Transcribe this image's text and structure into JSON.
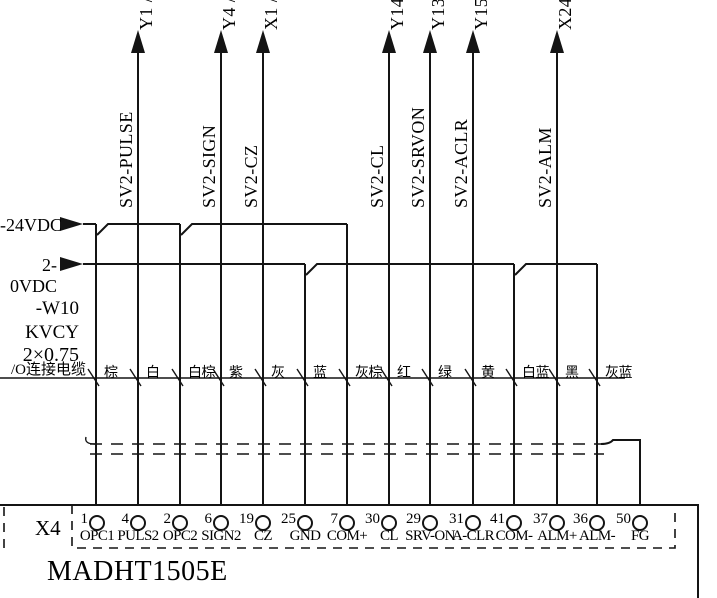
{
  "title_block": {
    "device_model": "MADHT1505E",
    "connector": "X4"
  },
  "rails": [
    {
      "label": "-24VDC",
      "y": 224,
      "x_start": 83,
      "taps": [
        96,
        180
      ],
      "x_end": 347
    },
    {
      "label": "2-0VDC",
      "y": 264,
      "x_start": 83,
      "taps": [
        305,
        514
      ],
      "x_end": 597
    }
  ],
  "cable_note": {
    "lines": [
      "-W10",
      "KVCY",
      "2×0.75",
      "/O连接电缆"
    ]
  },
  "signals": [
    {
      "x": 138,
      "name": "SV2-PULSE",
      "target": "Y1 /"
    },
    {
      "x": 221,
      "name": "SV2-SIGN",
      "target": "Y4 /"
    },
    {
      "x": 263,
      "name": "SV2-CZ",
      "target": "X1 /"
    },
    {
      "x": 389,
      "name": "SV2-CL",
      "target": "Y14"
    },
    {
      "x": 430,
      "name": "SV2-SRVON",
      "target": "Y13"
    },
    {
      "x": 473,
      "name": "SV2-ACLR",
      "target": "Y15"
    },
    {
      "x": 557,
      "name": "SV2-ALM",
      "target": "X24"
    }
  ],
  "wires": [
    {
      "x": 96,
      "color": "棕",
      "top": 224
    },
    {
      "x": 138,
      "color": "白",
      "top": 50
    },
    {
      "x": 180,
      "color": "白棕",
      "top": 224
    },
    {
      "x": 221,
      "color": "紫",
      "top": 50
    },
    {
      "x": 263,
      "color": "灰",
      "top": 50
    },
    {
      "x": 305,
      "color": "蓝",
      "top": 264
    },
    {
      "x": 347,
      "color": "灰棕",
      "top": 224
    },
    {
      "x": 389,
      "color": "红",
      "top": 50
    },
    {
      "x": 430,
      "color": "绿",
      "top": 50
    },
    {
      "x": 473,
      "color": "黄",
      "top": 50
    },
    {
      "x": 514,
      "color": "白蓝",
      "top": 264
    },
    {
      "x": 557,
      "color": "黑",
      "top": 50
    },
    {
      "x": 597,
      "color": "灰蓝",
      "top": 264
    }
  ],
  "pins": [
    {
      "x": 97,
      "number": "1",
      "label": "OPC1"
    },
    {
      "x": 138,
      "number": "4",
      "label": "PULS2"
    },
    {
      "x": 180,
      "number": "2",
      "label": "OPC2"
    },
    {
      "x": 221,
      "number": "6",
      "label": "SIGN2"
    },
    {
      "x": 263,
      "number": "19",
      "label": "CZ"
    },
    {
      "x": 305,
      "number": "25",
      "label": "GND"
    },
    {
      "x": 347,
      "number": "7",
      "label": "COM+"
    },
    {
      "x": 389,
      "number": "30",
      "label": "CL"
    },
    {
      "x": 430,
      "number": "29",
      "label": "SRV-ON"
    },
    {
      "x": 473,
      "number": "31",
      "label": "A-CLR"
    },
    {
      "x": 514,
      "number": "41",
      "label": "COM-"
    },
    {
      "x": 557,
      "number": "37",
      "label": "ALM+"
    },
    {
      "x": 597,
      "number": "36",
      "label": "ALM-"
    },
    {
      "x": 640,
      "number": "50",
      "label": "FG"
    }
  ]
}
